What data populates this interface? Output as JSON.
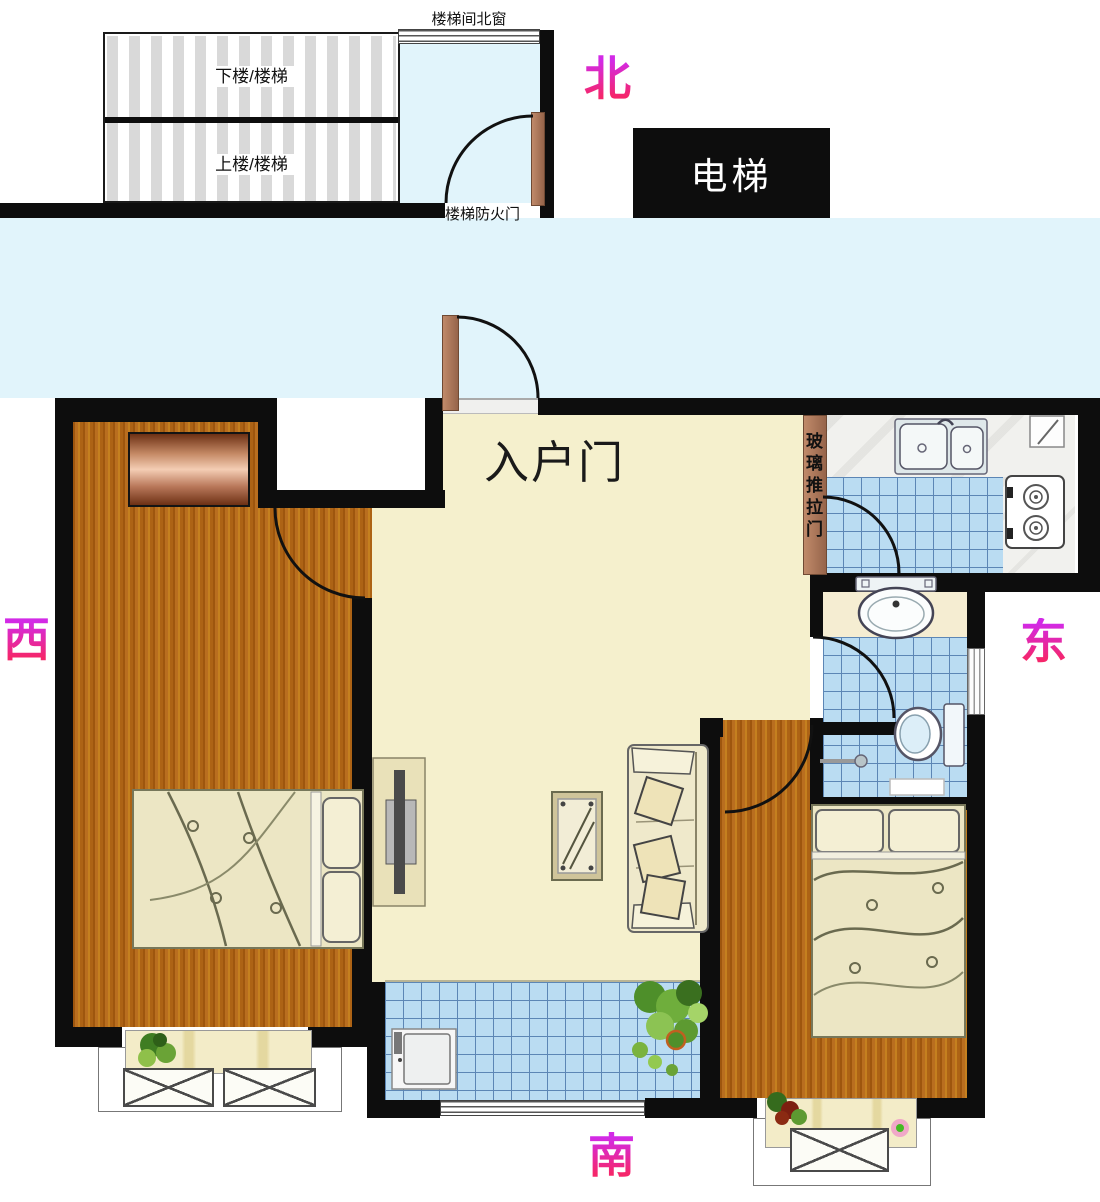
{
  "compass": {
    "north": "北",
    "west": "西",
    "east": "东",
    "south": "南"
  },
  "stairwell": {
    "window_label": "楼梯间北窗",
    "down_label": "下楼/楼梯",
    "up_label": "上楼/楼梯",
    "fire_door_label": "楼梯防火门"
  },
  "elevator_label": "电梯",
  "entry_door_label": "入户门",
  "sliding_door_label": "玻璃推拉门",
  "colors": {
    "wall": "#0d0d0d",
    "corridor_floor": "#e1f4fb",
    "living_floor": "#f5f0cd",
    "tile_floor": "#badcf2",
    "wood_floor": "#b96e1f",
    "direction_label_top": "#d22ae6",
    "direction_label_bottom": "#f5266b"
  }
}
